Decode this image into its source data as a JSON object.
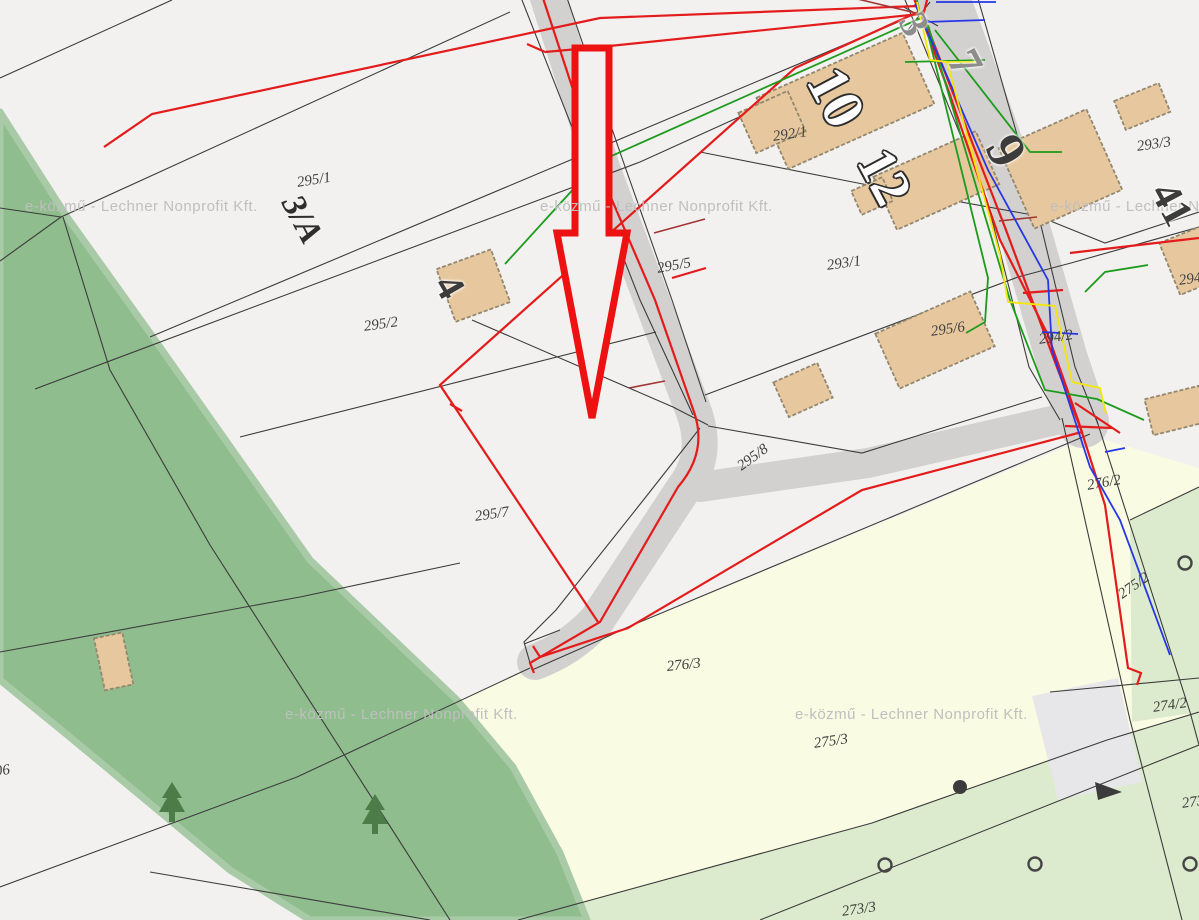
{
  "map": {
    "title": "cadastral-utility-map",
    "watermark": {
      "text": "e-közmű - Lechner Nonprofit Kft.",
      "color": "#bfbfbf",
      "positions": [
        [
          25,
          198
        ],
        [
          540,
          198
        ],
        [
          1050,
          198
        ],
        [
          285,
          706
        ],
        [
          795,
          706
        ]
      ]
    },
    "colors": {
      "background": "#f2f1ef",
      "forest_green": "#8fbd8d",
      "forest_edge": "#a9caa7",
      "field_cream": "#fafbe3",
      "field_light_green": "#dcebcd",
      "road_gray": "#d2d1cf",
      "building_tan": "#e7c89e",
      "building_outline": "#94876f",
      "parcel_line_black": "#3c3c3c",
      "utility_red": "#e41b1b",
      "utility_dark_red": "#a23535",
      "utility_green": "#1d9b1d",
      "utility_blue": "#2637e8",
      "utility_yellow": "#f3e60a",
      "highlight_arrow_red": "#ee1111",
      "gray_patch": "#e7e7e9"
    },
    "parcel_labels": [
      {
        "t": "295/1",
        "x": 296,
        "y": 176,
        "r": -9,
        "s": 15
      },
      {
        "t": "3/A",
        "x": 305,
        "y": 190,
        "r": 62,
        "s": 34,
        "b": 1
      },
      {
        "t": "295/2",
        "x": 363,
        "y": 320,
        "r": -8,
        "s": 15
      },
      {
        "t": "295/7",
        "x": 474,
        "y": 510,
        "r": -8,
        "s": 15
      },
      {
        "t": "295/5",
        "x": 656,
        "y": 262,
        "r": -10,
        "s": 15
      },
      {
        "t": "295/8",
        "x": 735,
        "y": 462,
        "r": -36,
        "s": 15
      },
      {
        "t": "292/1",
        "x": 772,
        "y": 130,
        "r": -8,
        "s": 15
      },
      {
        "t": "293/1",
        "x": 826,
        "y": 259,
        "r": -8,
        "s": 15
      },
      {
        "t": "293/3",
        "x": 1136,
        "y": 140,
        "r": -8,
        "s": 15
      },
      {
        "t": "295/6",
        "x": 930,
        "y": 325,
        "r": -8,
        "s": 15
      },
      {
        "t": "294/2",
        "x": 1038,
        "y": 333,
        "r": -8,
        "s": 15
      },
      {
        "t": "294/",
        "x": 1178,
        "y": 274,
        "r": -8,
        "s": 15
      },
      {
        "t": "276/2",
        "x": 1086,
        "y": 479,
        "r": -10,
        "s": 15
      },
      {
        "t": "275/2",
        "x": 1116,
        "y": 590,
        "r": -35,
        "s": 15
      },
      {
        "t": "274/2",
        "x": 1152,
        "y": 701,
        "r": -8,
        "s": 15
      },
      {
        "t": "273/",
        "x": 1181,
        "y": 797,
        "r": -8,
        "s": 15
      },
      {
        "t": "276/3",
        "x": 666,
        "y": 660,
        "r": -6,
        "s": 15
      },
      {
        "t": "275/3",
        "x": 813,
        "y": 737,
        "r": -8,
        "s": 15
      },
      {
        "t": "273/3",
        "x": 841,
        "y": 905,
        "r": -8,
        "s": 15
      },
      {
        "t": "06",
        "x": -6,
        "y": 765,
        "r": -8,
        "s": 15
      }
    ],
    "building_numbers": [
      {
        "t": "4",
        "x": 462,
        "y": 268,
        "r": 60,
        "s": 40,
        "cls": "dark"
      },
      {
        "t": "10",
        "x": 848,
        "y": 58,
        "r": 62,
        "s": 58,
        "cls": "white"
      },
      {
        "t": "12",
        "x": 896,
        "y": 140,
        "r": 62,
        "s": 54,
        "cls": "white"
      },
      {
        "t": "9",
        "x": 1024,
        "y": 126,
        "r": 62,
        "s": 54,
        "cls": "dark"
      },
      {
        "t": "7",
        "x": 980,
        "y": 42,
        "r": 62,
        "s": 46,
        "cls": "gray"
      },
      {
        "t": "3",
        "x": 927,
        "y": 6,
        "r": 62,
        "s": 40,
        "cls": "gray"
      },
      {
        "t": "41",
        "x": 1180,
        "y": 176,
        "r": 62,
        "s": 42,
        "cls": "dark"
      }
    ]
  }
}
